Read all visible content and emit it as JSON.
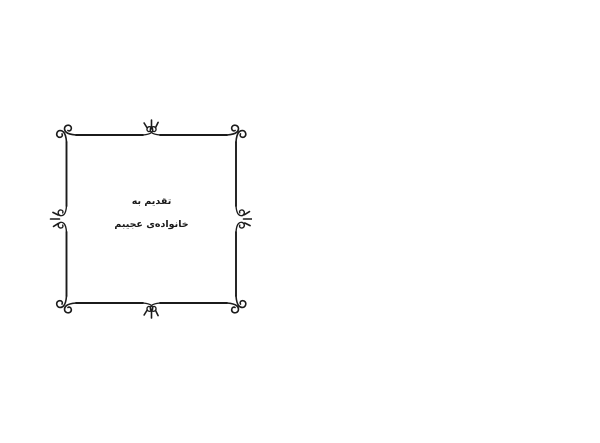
{
  "page": {
    "background_color": "#ffffff"
  },
  "dedication": {
    "direction": "rtl",
    "line1": "تقدیم به",
    "line2": "خانواده‌ی عجیبم"
  },
  "frame": {
    "name": "ornamental-swirl-frame",
    "ink_color": "#1b1b1b",
    "shape": "hand-drawn square border, spiral curls at corners, split mid-sides with facing curls and 3-stroke sprout flourish pointing outward on each side"
  }
}
